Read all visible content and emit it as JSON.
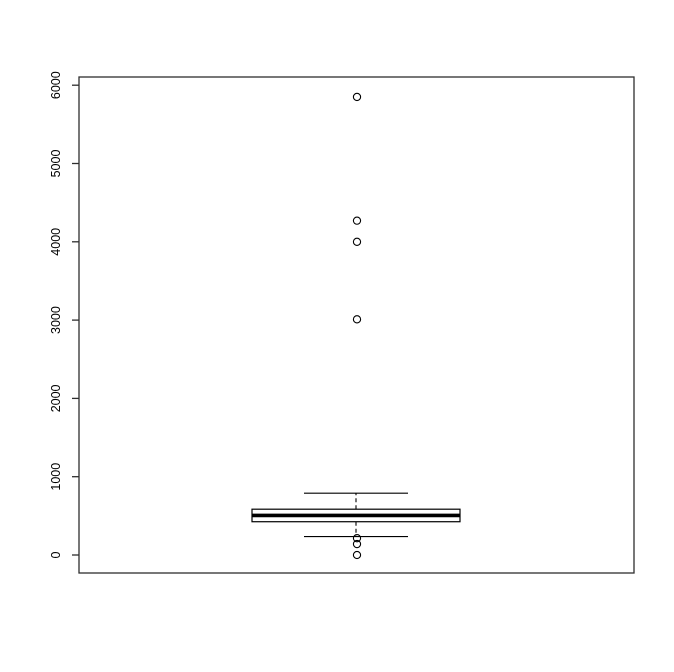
{
  "chart_data": {
    "type": "boxplot",
    "title": "",
    "xlabel": "",
    "ylabel": "",
    "ylim": [
      0,
      6000
    ],
    "yticks": [
      "0",
      "1000",
      "2000",
      "3000",
      "4000",
      "5000",
      "6000"
    ],
    "ytick_values": [
      0,
      1000,
      2000,
      3000,
      4000,
      5000,
      6000
    ],
    "grid": false,
    "legend": null,
    "series": [
      {
        "name": "box-1",
        "median": 505,
        "q1": 425,
        "q3": 585,
        "whisker_low": 235,
        "whisker_high": 790,
        "outliers": [
          0,
          140,
          215,
          3010,
          4000,
          4270,
          5850
        ]
      }
    ],
    "colors": {
      "background": "#ffffff",
      "frame": "#2e2e2e",
      "line": "#000000",
      "box_fill": "#ffffff",
      "tick_label": "#000000"
    }
  }
}
